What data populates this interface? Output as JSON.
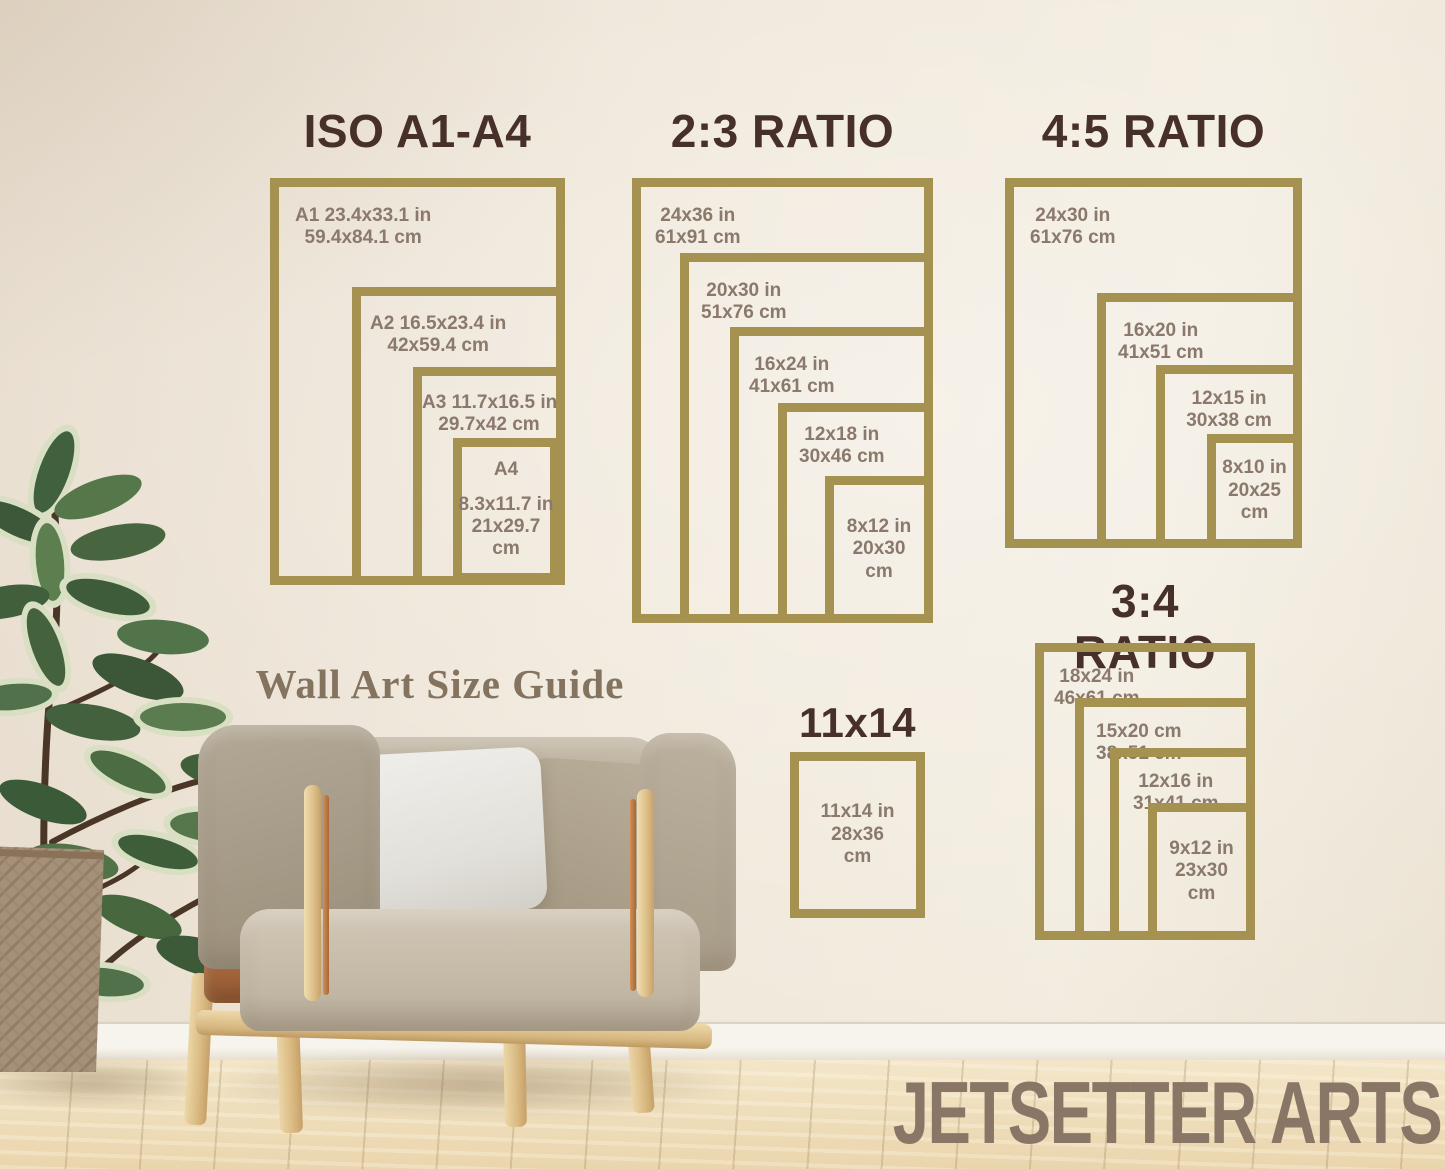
{
  "caption": "Wall Art Size Guide",
  "brand": "JETSETTER ARTS",
  "colors": {
    "frame_gold": "#a59250",
    "title_brown": "#47302a",
    "label_taupe": "#8a796c",
    "wall_cream": "#efe7d9"
  },
  "groups": {
    "iso": {
      "title": "ISO A1-A4",
      "frames": [
        {
          "lines": [
            "A1 23.4x33.1 in",
            "59.4x84.1 cm"
          ]
        },
        {
          "lines": [
            "A2 16.5x23.4 in",
            "42x59.4 cm"
          ]
        },
        {
          "lines": [
            "A3 11.7x16.5 in",
            "29.7x42 cm"
          ]
        },
        {
          "lines": [
            "A4",
            "8.3x11.7 in",
            "21x29.7",
            "cm"
          ]
        }
      ]
    },
    "r23": {
      "title": "2:3 RATIO",
      "frames": [
        {
          "lines": [
            "24x36 in",
            "61x91 cm"
          ]
        },
        {
          "lines": [
            "20x30 in",
            "51x76 cm"
          ]
        },
        {
          "lines": [
            "16x24 in",
            "41x61 cm"
          ]
        },
        {
          "lines": [
            "12x18 in",
            "30x46 cm"
          ]
        },
        {
          "lines": [
            "8x12 in",
            "20x30",
            "cm"
          ]
        }
      ]
    },
    "r45": {
      "title": "4:5 RATIO",
      "frames": [
        {
          "lines": [
            "24x30 in",
            "61x76 cm"
          ]
        },
        {
          "lines": [
            "16x20 in",
            "41x51 cm"
          ]
        },
        {
          "lines": [
            "12x15 in",
            "30x38 cm"
          ]
        },
        {
          "lines": [
            "8x10 in",
            "20x25",
            "cm"
          ]
        }
      ]
    },
    "r34": {
      "title": "3:4 RATIO",
      "frames": [
        {
          "lines": [
            "18x24 in",
            "46x61 cm"
          ]
        },
        {
          "lines": [
            "15x20 cm",
            "38x51 cm"
          ]
        },
        {
          "lines": [
            "12x16 in",
            "31x41 cm"
          ]
        },
        {
          "lines": [
            "9x12 in",
            "23x30",
            "cm"
          ]
        }
      ]
    },
    "s1114": {
      "title": "11x14",
      "frames": [
        {
          "lines": [
            "11x14 in",
            "28x36",
            "cm"
          ]
        }
      ]
    }
  }
}
